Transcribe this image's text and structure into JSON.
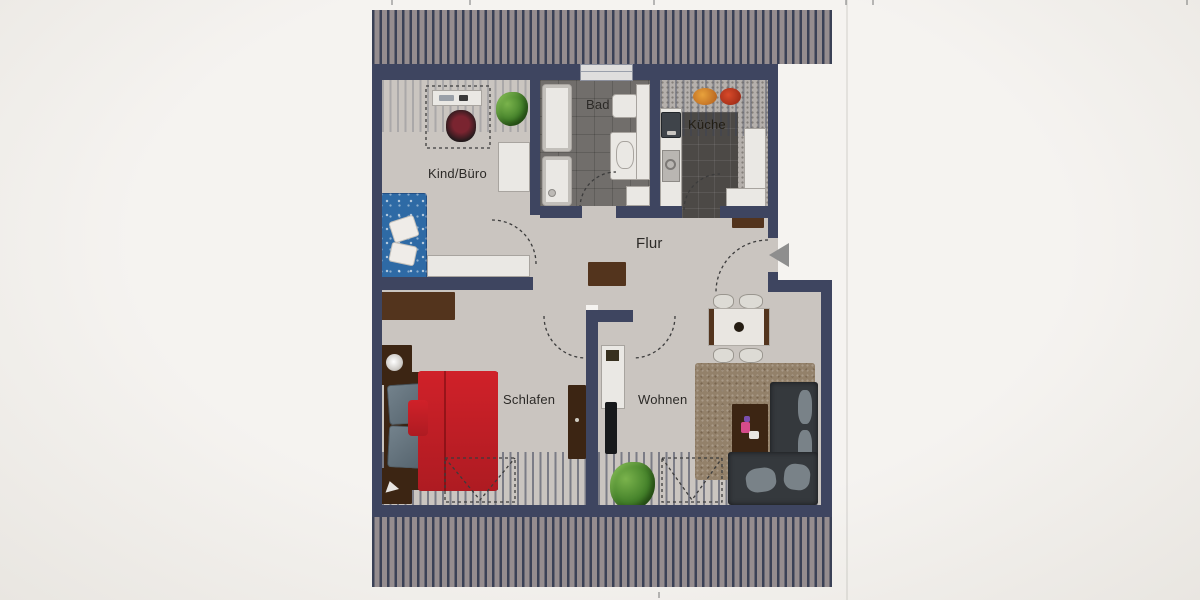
{
  "plan_title": "apartment-floor-plan",
  "rooms": {
    "kind_buero": "Kind/Büro",
    "bad": "Bad",
    "kueche": "Küche",
    "flur": "Flur",
    "schlafen": "Schlafen",
    "wohnen": "Wohnen"
  },
  "icons": {
    "entrance_arrow": "left-pointing-triangle"
  },
  "colors": {
    "page_bg": "#f1efec",
    "wall": "#3e4560",
    "floor": "#cac5c0",
    "roof_bg": "#958d8f",
    "roof_stripe": "#3a4156",
    "bad_floor": "#716e6b",
    "kitchen_floor": "#b5b0ac",
    "kitchen_tile": "#4c4946",
    "furniture_white": "#eae8e4",
    "furniture_border": "#a8a49f",
    "wood": "#53341d",
    "wood_dark": "#3c2513",
    "bed_red": "#c61f28",
    "pillow_grey": "#66757f",
    "sofa_blue": "#2e6aa5",
    "sofa_dark": "#35393d",
    "cushion_grey": "#7d868c",
    "carpet": "#93816a",
    "plant_green": "#4c8c2f",
    "chair_glass": "#dbd8d3",
    "door_dash": "#3c3c3c",
    "arrow_grey": "#8e8e8e",
    "label_text": "#2c2a27"
  }
}
